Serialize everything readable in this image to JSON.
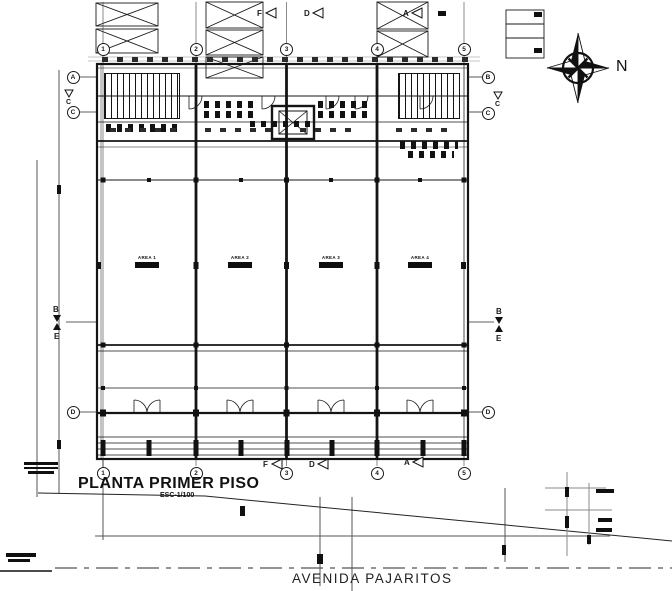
{
  "meta": {
    "title": "PLANTA PRIMER PISO",
    "scale": "ESC-1/100",
    "street": "AVENIDA PAJARITOS",
    "north_label": "N"
  },
  "grid": {
    "columns": [
      "1",
      "2",
      "3",
      "4",
      "5"
    ],
    "left_rows": [
      "A",
      "C",
      "D"
    ],
    "right_rows": [
      "B",
      "C",
      "D"
    ]
  },
  "markers": {
    "section_letters": [
      "F",
      "D",
      "A"
    ],
    "cut": {
      "top_label": "B",
      "bottom_label": "E"
    },
    "tri_label": "C"
  },
  "rooms": [
    {
      "name": "AREA 1"
    },
    {
      "name": "AREA 2"
    },
    {
      "name": "AREA 3"
    },
    {
      "name": "AREA 4"
    }
  ],
  "colors": {
    "ink": "#1a1a1a",
    "gray": "#8a8a8a"
  }
}
